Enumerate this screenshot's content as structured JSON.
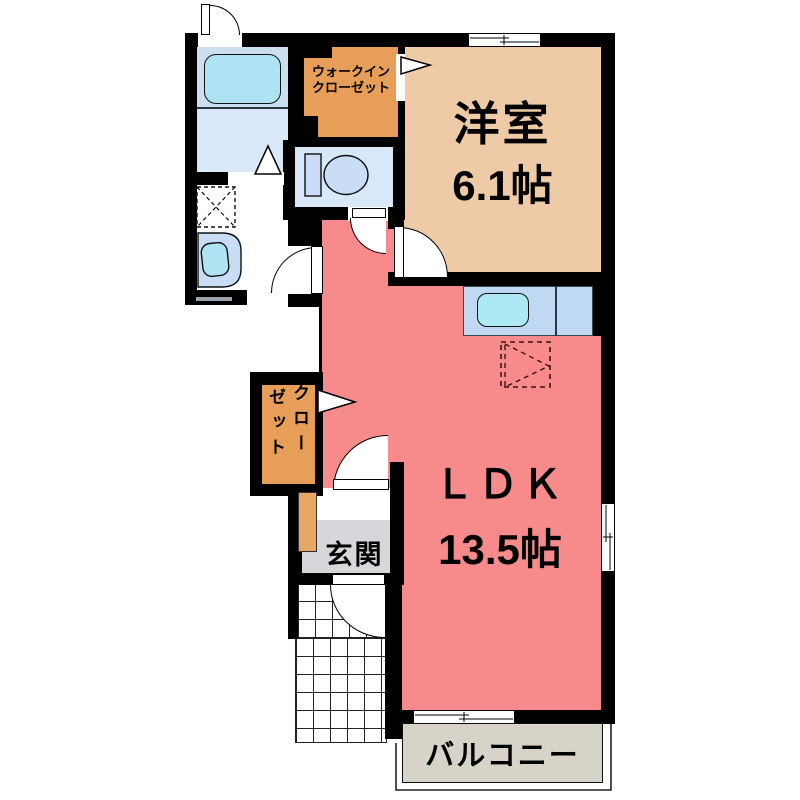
{
  "rooms": {
    "wic": {
      "line1": "ウォークイン",
      "line2": "クローゼット"
    },
    "western": {
      "name": "洋室",
      "size": "6.1帖"
    },
    "ldk": {
      "name": "ＬＤＫ",
      "size": "13.5帖"
    },
    "closet": {
      "col_right": "クロー",
      "col_left": "ゼット"
    },
    "genkan": {
      "name": "玄関"
    },
    "balcony": {
      "name": "バルコニー"
    }
  },
  "icons": {
    "fixtures": [
      "bathtub-icon",
      "bathroom-folding-door-icon",
      "toilet-icon",
      "washbasin-icon",
      "washing-machine-space-icon",
      "kitchen-sink-icon",
      "refrigerator-space-icon",
      "sliding-window-icon",
      "door-swing-arc"
    ]
  },
  "colors": {
    "wall": "#000000",
    "ldk_fill": "#F78B8B",
    "western_room_fill": "#EECAA6",
    "wic_fill": "#E79E58",
    "closet_fill": "#E79E58",
    "shoe_cabinet_fill": "#E8A863",
    "bathroom_fill": "#CBDFF0",
    "bathroom_lower_fill": "#D9E8F8",
    "bathtub_fill": "#ADE3F2",
    "toilet_room_fill": "#D9E8F8",
    "kitchen_counter_fill": "#BFD9F2",
    "sink_fill": "#ADE8F5",
    "genkan_fill": "#D6D7DB",
    "balcony_fill": "#D8D3C8"
  }
}
